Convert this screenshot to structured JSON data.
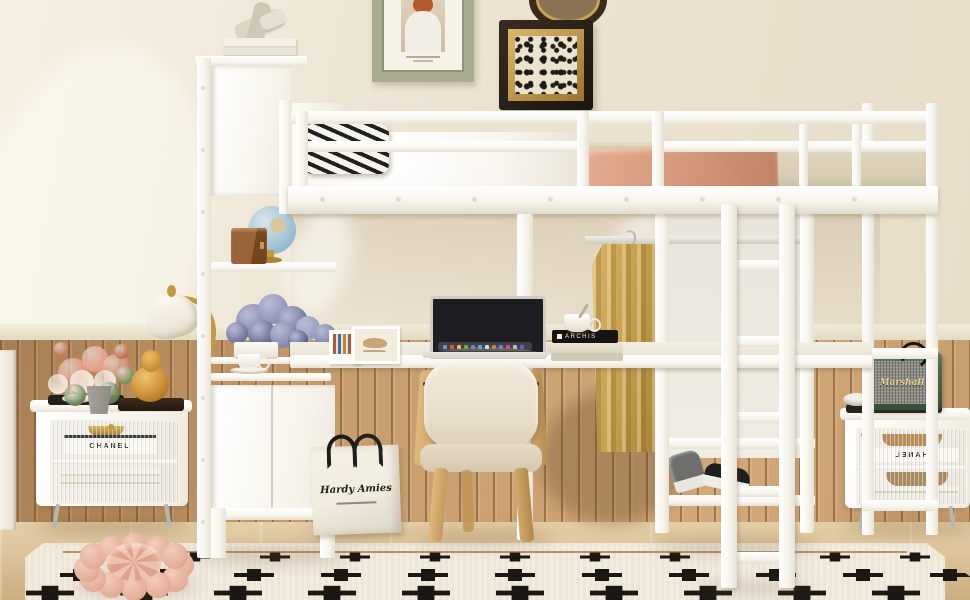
{
  "scene": {
    "type": "product-photo",
    "subject": "White metal loft bed with under-bed desk, storage shelf tower, wardrobe rod, shoe shelves and ladder in a beige bedroom with wood wainscoting"
  },
  "text": {
    "left_nightstand_books": "CHANEL",
    "right_nightstand_books": "CHANEL",
    "speaker_logo": "Marshall",
    "shopping_bag_logo": "Hardy Amies",
    "desk_book_spine": "ARCHIS"
  },
  "palette": {
    "wall": "#ece3d1",
    "wall_light": "#f7f1e3",
    "wainscot": "#c79d6f",
    "wainscot_dark": "#a87e52",
    "wainscot_line": "#8a6743",
    "wainscot_rail": "#efe8d6",
    "floor": "#ddc49b",
    "floor_dark": "#cbae80",
    "rug": "#f2ecdf",
    "rug_line": "#a87f4e",
    "rug_motif": "#1b1712",
    "white": "#ffffff",
    "white_dim": "#e9e4d8",
    "bedding_white": "#f7f4ed",
    "bedding_tan": "#d9cdb3",
    "stripe_black": "#22201d",
    "throw_salmon": "#d79a7d",
    "shirt_tan": "#c6a050",
    "chair_cushion": "#eae0cd",
    "chair_wood": "#d3aa6d",
    "speaker_green": "#4c6a4f",
    "speaker_grey": "#8d8c85",
    "gold": "#c29a3f",
    "amber": "#cd8f35",
    "purple": "#7d80a6",
    "coral": "#e08a74",
    "leaf": "#6a8352",
    "pouf": "#e9b9a8",
    "frame_green": "#a9ac93",
    "frame_dark": "#241d18",
    "frame_gold": "#bd9347",
    "art_cream": "#ece3cc",
    "globe_blue": "#a6c6d8",
    "box_brown": "#94603a",
    "bag": "#f1ece0",
    "ink": "#23201c",
    "silver": "#d6d3cd",
    "glass": "#e9e6df",
    "chrome": "#b9b6ae"
  }
}
